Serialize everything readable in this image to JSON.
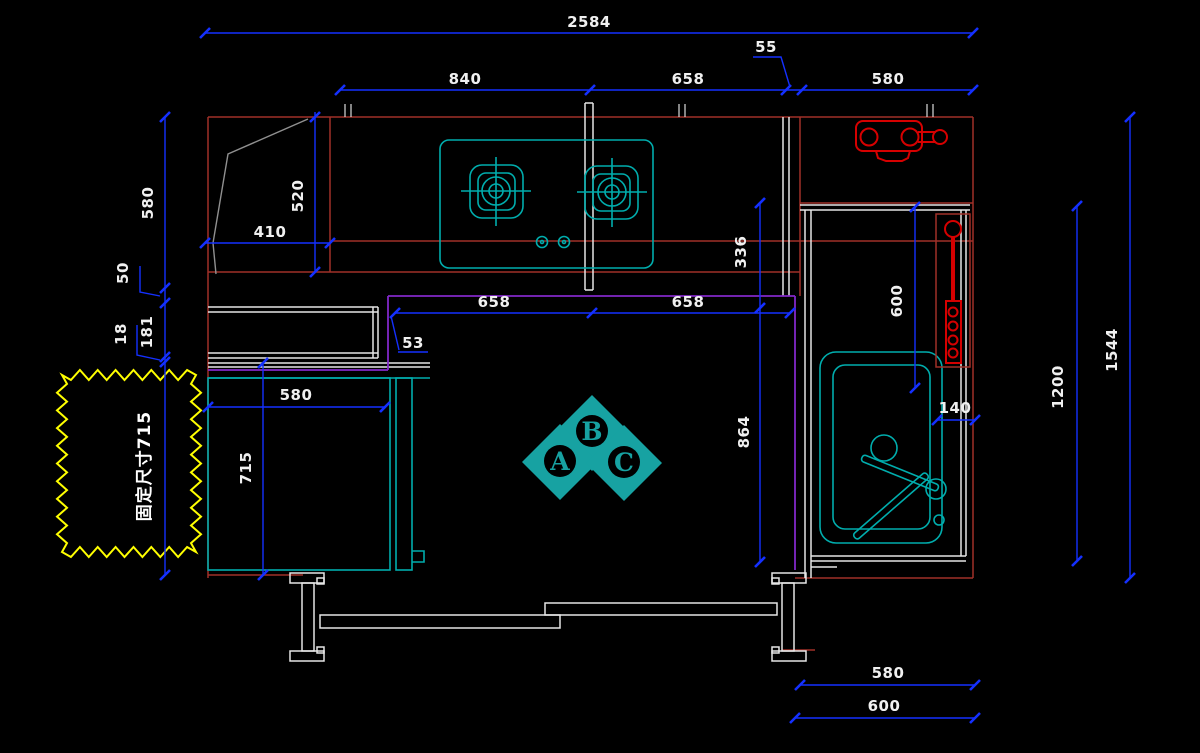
{
  "drawing": {
    "dims": {
      "overall_width": "2584",
      "seg_840": "840",
      "seg_658_top": "658",
      "seg_55": "55",
      "seg_580_top": "580",
      "left_580": "580",
      "left_50": "50",
      "left_181": "181",
      "left_18": "18",
      "hood_520": "520",
      "hood_410": "410",
      "counter_658_left": "658",
      "counter_658_right": "658",
      "counter_53": "53",
      "right_336": "336",
      "right_600": "600",
      "right_140": "140",
      "right_864": "864",
      "fridge_580": "580",
      "fridge_715": "715",
      "height_1200": "1200",
      "height_1544": "1544",
      "bottom_580": "580",
      "bottom_600": "600"
    },
    "cloud_note": "固定尺寸715",
    "markers": {
      "a": "A",
      "b": "B",
      "c": "C"
    },
    "colors": {
      "background": "#000000",
      "dimension_blue": "#1430FF",
      "wall_white": "#E6E6E6",
      "cabinet_red": "#A03028",
      "fixture_red": "#D60000",
      "appliance_teal": "#00ADAD",
      "marker_teal": "#17A2A2",
      "counter_purple": "#8228C8",
      "cloud_yellow": "#FFFF00",
      "hood_gray": "#909090"
    }
  }
}
